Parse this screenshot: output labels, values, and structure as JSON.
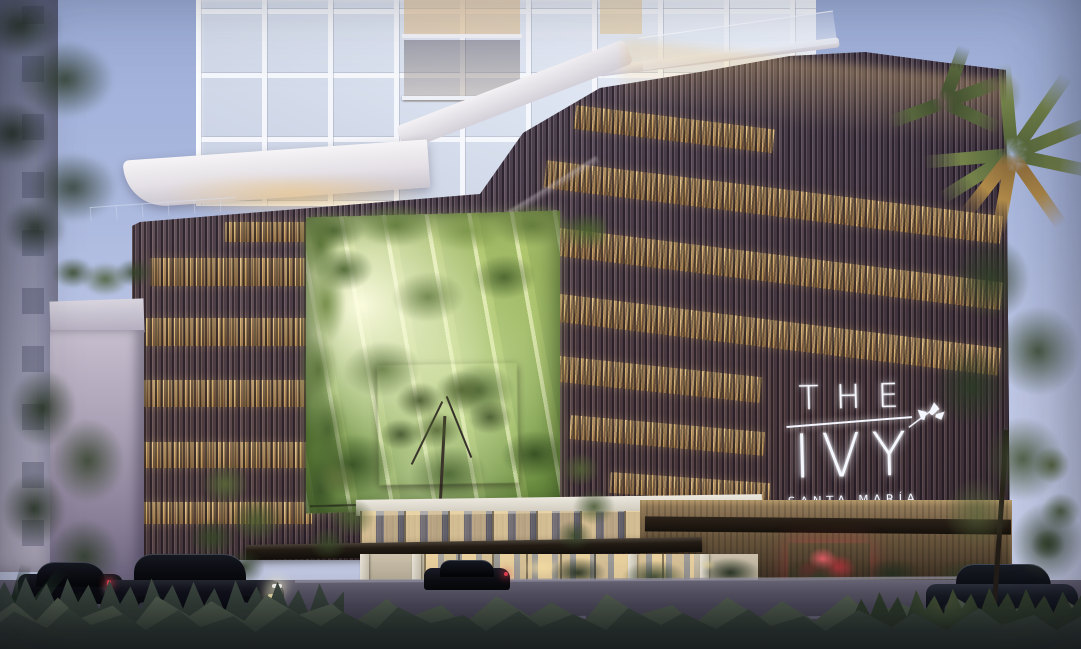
{
  "signage": {
    "the": "THE",
    "ivy": "IVY",
    "club": "SANTA MARÍA",
    "club_sub": "GOLF & COUNTRY CLUB"
  },
  "palette": {
    "sky_top": "#9daed8",
    "sky_bottom": "#ccd2ea",
    "tower_white": "#eff3fa",
    "facade_slat_dark": "#352d3b",
    "facade_slat_light": "#7d6f7c",
    "facade_bronze": "#96693c",
    "window_glow": "#f2ca7c",
    "atrium_bright": "#f5ffdc",
    "atrium_green": "#84a94f",
    "canopy_dark": "#241d16",
    "entrance_warm": "#ecd4a2",
    "stone_wall": "#6f5b41",
    "red_accent": "#c83440",
    "road": "#595666",
    "foreground_green": "#333d33",
    "signage_white": "#f5f8ff",
    "palm_green": "#74834a",
    "palm_warm": "#af8a49"
  }
}
